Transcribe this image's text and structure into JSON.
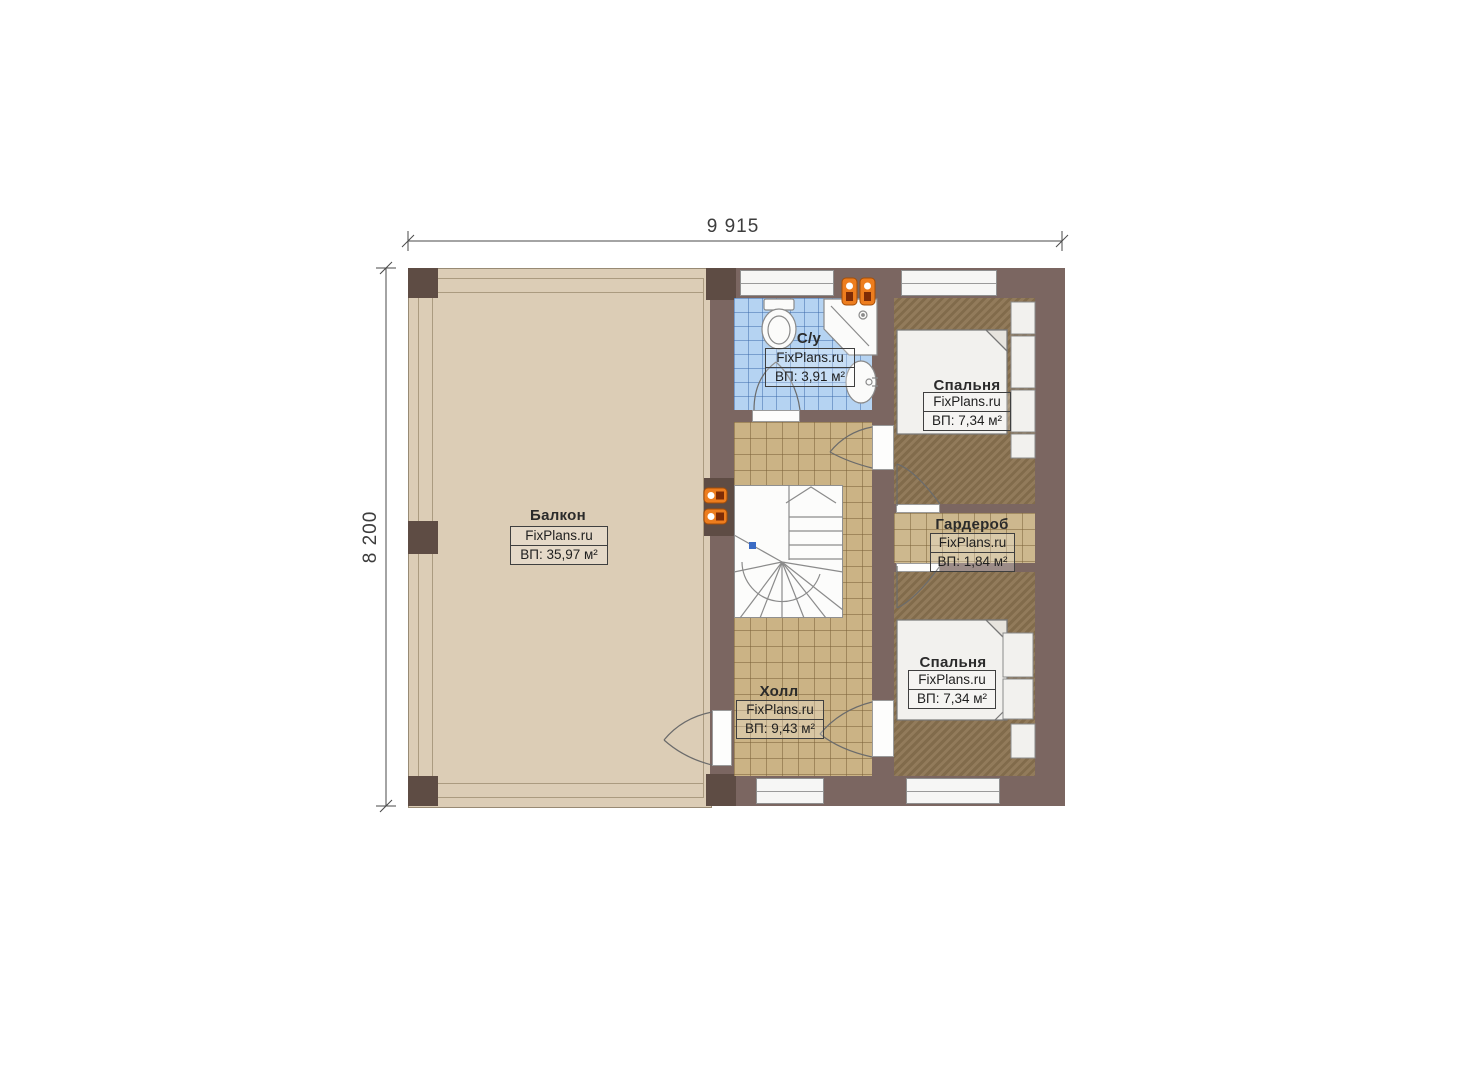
{
  "plan_title": "Floor plan, second floor",
  "dimensions": {
    "top": "9 915",
    "left": "8 200"
  },
  "watermark": "FixPlans.ru",
  "rooms": {
    "balcony": {
      "name": "Балкон",
      "area": "ВП: 35,97 м²"
    },
    "bathroom": {
      "name": "С/у",
      "area": "ВП: 3,91 м²"
    },
    "bedroom_top": {
      "name": "Спальня",
      "area": "ВП: 7,34 м²"
    },
    "wardrobe": {
      "name": "Гардероб",
      "area": "ВП: 1,84 м²"
    },
    "bedroom_bottom": {
      "name": "Спальня",
      "area": "ВП: 7,34 м²"
    },
    "hall": {
      "name": "Холл",
      "area": "ВП: 9,43 м²"
    }
  },
  "colors": {
    "wall": "#7b6661",
    "column": "#5e4c44",
    "balcony_floor": "#dccdb6",
    "hall_floor": "#cbb385",
    "bathroom_floor": "#b5d3f2",
    "bedroom_floor": "#8b7351",
    "wardrobe_floor": "#cdb88e",
    "radiator": "#ed7d1e",
    "stair_marker": "#3a6bc4"
  }
}
